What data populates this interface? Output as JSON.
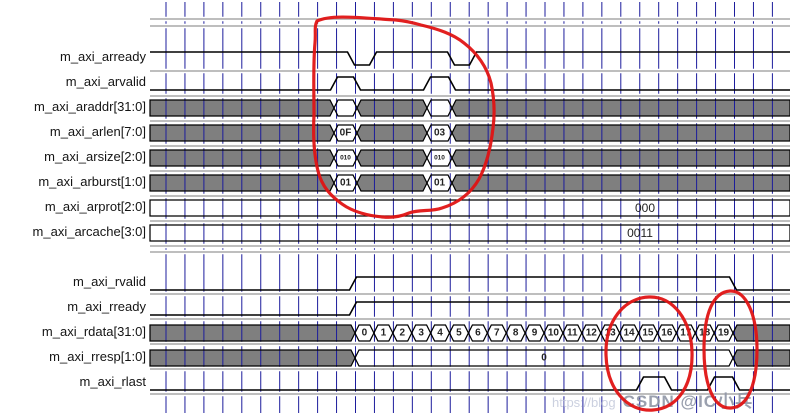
{
  "palette": {
    "grid_blue": "#1c1c9c",
    "wave_black": "#000000",
    "bus_gray": "#7f7f7f",
    "bus_white": "#ffffff",
    "separator_gray": "#b5b5b5",
    "annotation_red": "#e01414",
    "value_text": "#222222",
    "label_text": "#141414"
  },
  "signals": {
    "group1": [
      {
        "name": "m_axi_arready",
        "kind": "bit",
        "initial": 1,
        "toggles_px": [
          351,
          373,
          451,
          473
        ]
      },
      {
        "name": "m_axi_arvalid",
        "kind": "bit",
        "initial": 0,
        "toggles_px": [
          334,
          357,
          427,
          452
        ]
      },
      {
        "name": "m_axi_araddr[31:0]",
        "kind": "bus",
        "segments": [
          {
            "from": 150,
            "to": 334,
            "style": "unknown"
          },
          {
            "from": 334,
            "to": 357,
            "style": "value",
            "label": ""
          },
          {
            "from": 357,
            "to": 427,
            "style": "unknown"
          },
          {
            "from": 427,
            "to": 452,
            "style": "value",
            "label": ""
          },
          {
            "from": 452,
            "to": 790,
            "style": "unknown"
          }
        ]
      },
      {
        "name": "m_axi_arlen[7:0]",
        "kind": "bus",
        "segments": [
          {
            "from": 150,
            "to": 334,
            "style": "unknown"
          },
          {
            "from": 334,
            "to": 357,
            "style": "value",
            "label": "0F"
          },
          {
            "from": 357,
            "to": 427,
            "style": "unknown"
          },
          {
            "from": 427,
            "to": 452,
            "style": "value",
            "label": "03"
          },
          {
            "from": 452,
            "to": 790,
            "style": "unknown"
          }
        ]
      },
      {
        "name": "m_axi_arsize[2:0]",
        "kind": "bus",
        "small_text": true,
        "segments": [
          {
            "from": 150,
            "to": 334,
            "style": "unknown"
          },
          {
            "from": 334,
            "to": 357,
            "style": "value",
            "label": "010"
          },
          {
            "from": 357,
            "to": 427,
            "style": "unknown"
          },
          {
            "from": 427,
            "to": 452,
            "style": "value",
            "label": "010"
          },
          {
            "from": 452,
            "to": 790,
            "style": "unknown"
          }
        ]
      },
      {
        "name": "m_axi_arburst[1:0]",
        "kind": "bus",
        "segments": [
          {
            "from": 150,
            "to": 334,
            "style": "unknown"
          },
          {
            "from": 334,
            "to": 357,
            "style": "value",
            "label": "01"
          },
          {
            "from": 357,
            "to": 427,
            "style": "unknown"
          },
          {
            "from": 427,
            "to": 452,
            "style": "value",
            "label": "01"
          },
          {
            "from": 452,
            "to": 790,
            "style": "unknown"
          }
        ]
      },
      {
        "name": "m_axi_arprot[2:0]",
        "kind": "bus",
        "segments": [
          {
            "from": 150,
            "to": 790,
            "style": "value_flat",
            "label": "000",
            "label_x": 645
          }
        ]
      },
      {
        "name": "m_axi_arcache[3:0]",
        "kind": "bus",
        "segments": [
          {
            "from": 150,
            "to": 790,
            "style": "value_flat",
            "label": "0011",
            "label_x": 640
          }
        ]
      }
    ],
    "group2": [
      {
        "name": "m_axi_rvalid",
        "kind": "bit",
        "initial": 0,
        "toggles_px": [
          353,
          733
        ]
      },
      {
        "name": "m_axi_rready",
        "kind": "bit",
        "initial": 0,
        "toggles_px": [
          353
        ]
      },
      {
        "name": "m_axi_rdata[31:0]",
        "kind": "bus",
        "segments": [
          {
            "from": 150,
            "to": 355,
            "style": "unknown"
          },
          {
            "from": 355,
            "to": 733,
            "style": "beats",
            "labels": [
              "0",
              "1",
              "2",
              "3",
              "4",
              "5",
              "6",
              "7",
              "8",
              "9",
              "10",
              "11",
              "12",
              "13",
              "14",
              "15",
              "16",
              "17",
              "18",
              "19"
            ]
          },
          {
            "from": 733,
            "to": 790,
            "style": "unknown"
          }
        ]
      },
      {
        "name": "m_axi_rresp[1:0]",
        "kind": "bus",
        "segments": [
          {
            "from": 150,
            "to": 355,
            "style": "unknown"
          },
          {
            "from": 355,
            "to": 733,
            "style": "value",
            "label": "0",
            "label_x": 544
          },
          {
            "from": 733,
            "to": 790,
            "style": "unknown"
          }
        ]
      },
      {
        "name": "m_axi_rlast",
        "kind": "bit",
        "initial": 0,
        "toggles_px": [
          640,
          668,
          711,
          736
        ]
      }
    ]
  },
  "annotations": [
    {
      "name": "ar-handshake-circle",
      "color": "#e01414"
    },
    {
      "name": "rlast-first-burst-circle",
      "color": "#e01414"
    },
    {
      "name": "rlast-second-burst-circle",
      "color": "#e01414"
    }
  ],
  "watermark": {
    "prefix": "https://blog",
    "text": "CSDN @IC小兵"
  }
}
